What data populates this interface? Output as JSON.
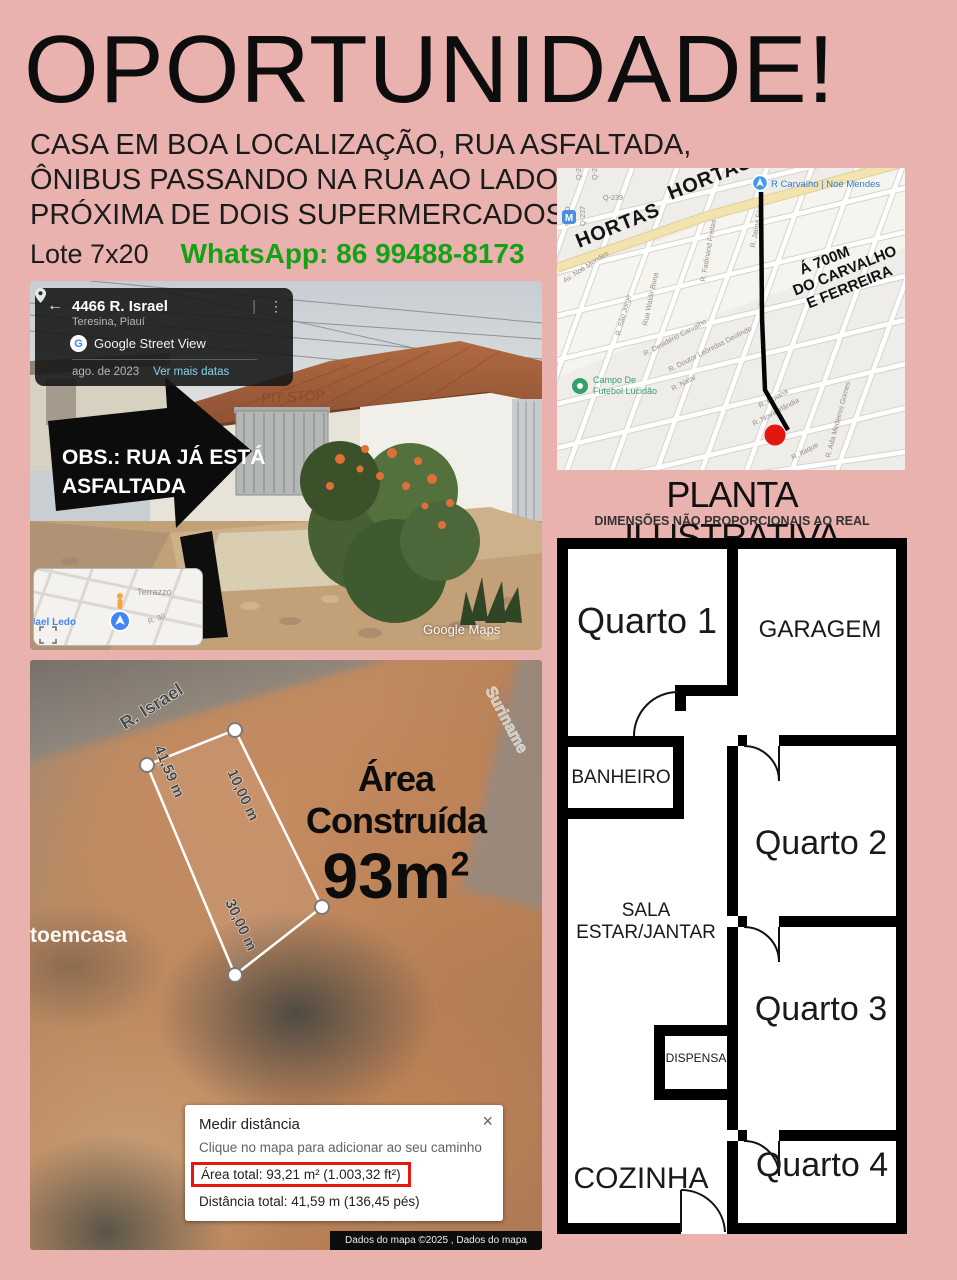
{
  "colors": {
    "background": "#eab2ae",
    "whatsapp_green": "#15a115",
    "highlight_red": "#e8170d",
    "map_marker_red": "#e31710",
    "link_teal": "#85d4e9",
    "maps_blue": "#4285f4"
  },
  "header": {
    "title": "OPORTUNIDADE!",
    "line1": "CASA EM BOA LOCALIZAÇÃO, RUA ASFALTADA,",
    "line2": "ÔNIBUS PASSANDO NA RUA AO LADO,",
    "line3": "PRÓXIMA DE DOIS SUPERMERCADOS.",
    "lot": "Lote 7x20",
    "whatsapp": "WhatsApp: 86 99488-8173"
  },
  "street_view": {
    "panel": {
      "back": "←",
      "address": "4466 R. Israel",
      "city": "Teresina, Piauí",
      "g_letter": "G",
      "brand": "Google Street View",
      "date": "ago. de 2023",
      "link": "Ver mais datas",
      "sep": "|",
      "dots": "⋮"
    },
    "note1": "OBS.: RUA JÁ ESTÁ",
    "note2": "ASFALTADA",
    "sign": "PIT STOP",
    "watermark": "Google Maps",
    "minimap": {
      "terrazzo": "Terrazzo",
      "jael": "Jael Ledo",
      "r30": "R. 30"
    }
  },
  "map": {
    "hortas_1": "HORTAS",
    "hortas_2": "HORTAS",
    "pin_label": "R Carvalho | Noé Mendes",
    "note_line1": "Á 700M",
    "note_line2": "DO CARVALHO",
    "note_line3": "E FERREIRA",
    "poi_line1": "Campo De",
    "poi_line2": "Futebol Lucidão",
    "streets": {
      "av_noe": "Av. Noé Mendes",
      "sao_jorge": "R. São Jorge",
      "waldir": "Rua Waldir Bona",
      "fadinand": "R. Fadinand Freitas",
      "jaime": "R. Jaime Fortes",
      "desiderio": "R. Desidério Carvalho",
      "leonidas": "R. Doutor Leônidas Deolindo",
      "natal": "R. Natal",
      "goiana": "R. Goiana",
      "nova": "R. Nova Irlândia",
      "itaque": "R. Itaque",
      "ada": "R. Ada Medeiros Gomes"
    },
    "quads": {
      "q239": "Q-239",
      "q237": "Q-237",
      "q962": "962-D",
      "q2a": "Q-2",
      "q2b": "Q-2"
    },
    "metro": "M"
  },
  "plan": {
    "heading": "PLANTA ILUSTRATIVA",
    "subheading": "DIMENSÕES NÃO PROPORCIONAIS AO REAL",
    "rooms": {
      "q1": "Quarto 1",
      "garagem": "GARAGEM",
      "banheiro": "BANHEIRO",
      "sala1": "SALA",
      "sala2": "ESTAR/JANTAR",
      "q2": "Quarto 2",
      "q3": "Quarto 3",
      "dispensa": "DISPENSA",
      "cozinha": "COZINHA",
      "q4": "Quarto 4"
    }
  },
  "aerial": {
    "street": "R. Israel",
    "cross_street": "Suriname",
    "faint": "202",
    "area_title": "Área Construída",
    "area_value": "93m",
    "area_sup": "2",
    "measures": {
      "total": "41,59 m",
      "m10": "10,00 m",
      "m30": "30,00 m"
    },
    "watermark_left": "toemcasa",
    "dialog": {
      "title": "Medir distância",
      "hint": "Clique no mapa para adicionar ao seu caminho",
      "close": "×",
      "area_line": "Área total: 93,21 m² (1.003,32 ft²)",
      "dist_line": "Distância total: 41,59 m (136,45 pés)"
    },
    "credit": "Dados do mapa ©2025 , Dados do mapa"
  }
}
